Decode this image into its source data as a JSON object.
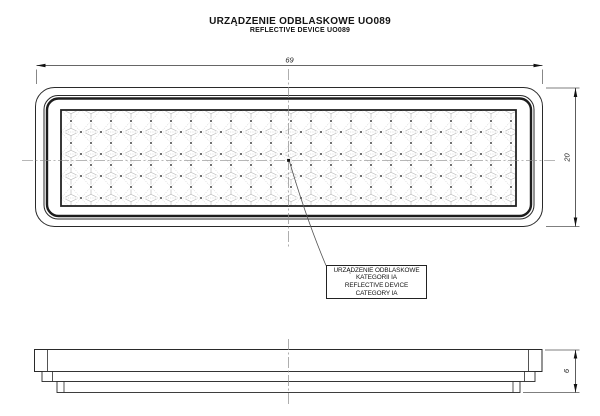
{
  "title": {
    "line1": "URZĄDZENIE ODBLASKOWE UO089",
    "line2": "REFLECTIVE DEVICE UO089"
  },
  "front_view": {
    "description": "front view of rectangular reflector with rounded corners and retroreflective prism pattern",
    "width_dim": "69",
    "height_dim": "20"
  },
  "side_view": {
    "description": "side profile of reflector, stepped cross-section",
    "thickness_dim": "6"
  },
  "callout": {
    "line1": "URZĄDZENIE ODBLASKOWE",
    "line2": "KATEGORII IA",
    "line3": "REFLECTIVE DEVICE",
    "line4": "CATEGORY IA"
  },
  "colors": {
    "line": "#2a2a2a",
    "centerline": "#8c8c8c",
    "pattern_mesh": "#adadad",
    "background": "#ffffff"
  }
}
